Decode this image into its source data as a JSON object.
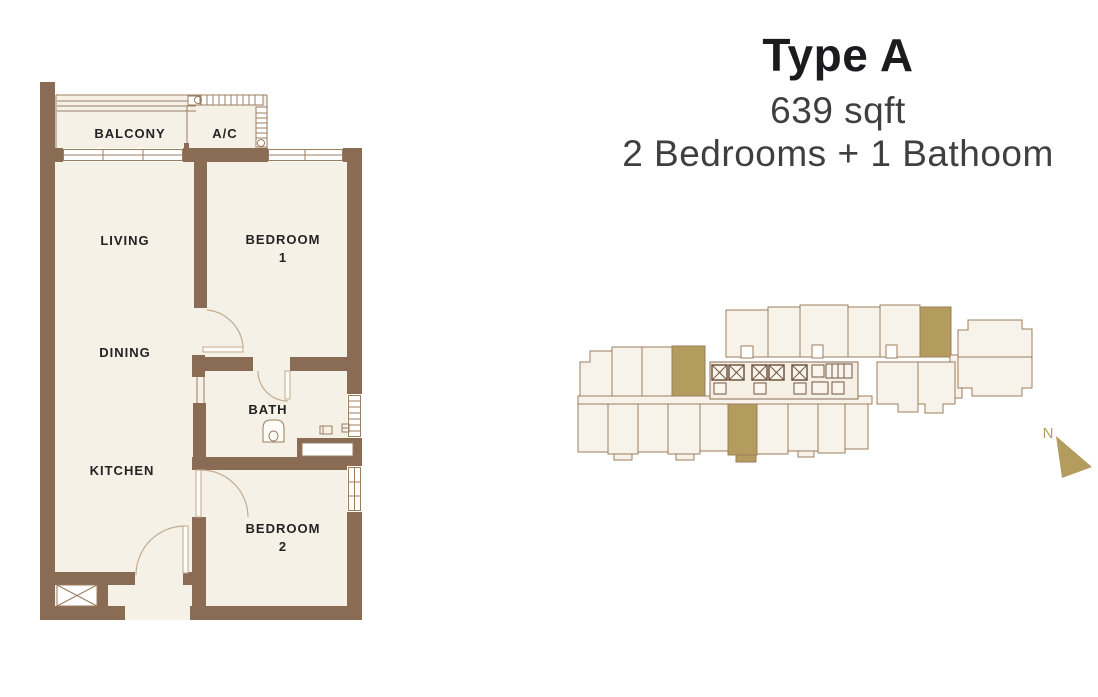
{
  "title": {
    "name": "Type A",
    "area": "639 sqft",
    "configuration": "2 Bedrooms + 1 Bathoom"
  },
  "floor_plan": {
    "rooms": {
      "balcony": "BALCONY",
      "ac": "A/C",
      "living": "LIVING",
      "bedroom1_line1": "BEDROOM",
      "bedroom1_line2": "1",
      "dining": "DINING",
      "bath": "BATH",
      "kitchen": "KITCHEN",
      "bedroom2_line1": "BEDROOM",
      "bedroom2_line2": "2"
    }
  },
  "key_plan": {
    "north_label": "N",
    "highlighted_unit_count": 3
  },
  "colors": {
    "wall": "#8a6b54",
    "room_fill": "#f6f1e7",
    "outline": "#9b7d60",
    "highlight_gold": "#b49b5e",
    "key_plan_fill": "#f8f3ea",
    "key_plan_outline": "#9c7e5d",
    "title_text": "#1c1c1e",
    "subtitle_text": "#3f3f3f",
    "label_text": "#232323",
    "background": "#ffffff"
  }
}
